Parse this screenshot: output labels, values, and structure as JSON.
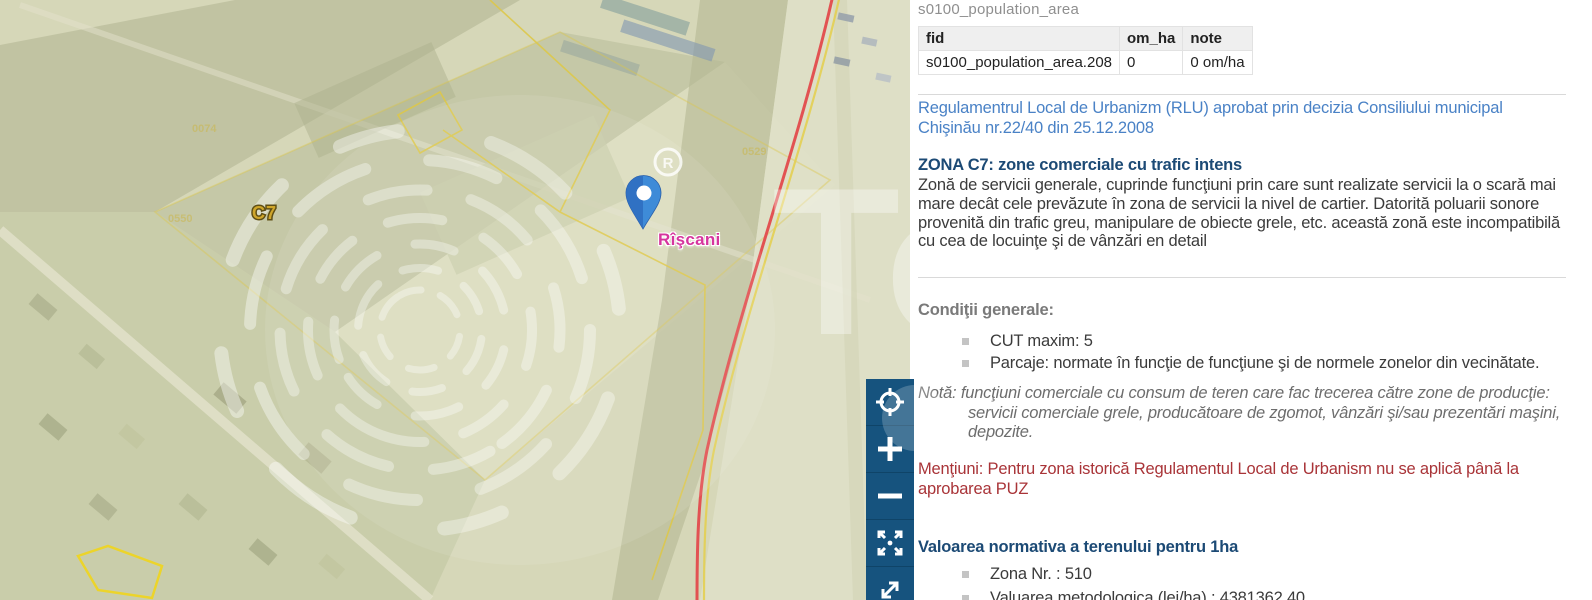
{
  "map": {
    "zone_label": "C7",
    "marker_label": "Rîşcani",
    "registered_mark": "R",
    "watermark_text": "To",
    "parcel_numbers": [
      "0074",
      "0550",
      "0529"
    ],
    "colors": {
      "base_khaki": "#d6d7b8",
      "zone_gold": "#c9a227",
      "marker_pink": "#d6359e",
      "marker_blue": "#3e8bd8",
      "route_red": "#e25252",
      "parcel_yellow": "#ddc84a"
    }
  },
  "toolbar": {
    "background": "#16537e",
    "buttons": [
      {
        "name": "locate",
        "icon": "target-icon"
      },
      {
        "name": "zoom-in",
        "icon": "plus-icon"
      },
      {
        "name": "zoom-out",
        "icon": "minus-icon"
      },
      {
        "name": "full-extent",
        "icon": "expand-arrows-icon"
      },
      {
        "name": "resize-diagonal",
        "icon": "diagonal-arrows-icon"
      }
    ]
  },
  "panel": {
    "table": {
      "title": "s0100_population_area",
      "columns": [
        "fid",
        "om_ha",
        "note"
      ],
      "rows": [
        [
          "s0100_population_area.208",
          "0",
          "0 om/ha"
        ]
      ]
    },
    "rlu_text": "Regulamentrul Local de Urbanizm (RLU) aprobat prin decizia Consiliului municipal Chişinău nr.22/40 din 25.12.2008",
    "zone_heading": "ZONA C7: zone comerciale cu trafic intens",
    "zone_description": "Zonă de servicii generale, cuprinde funcţiuni prin care sunt realizate servicii la o scară mai mare decât cele prevăzute în zona de servicii la nivel de cartier. Datorită poluarii sonore provenită din trafic greu, manipulare de obiecte grele, etc. această zonă este incompatibilă cu cea de locuinţe şi de vânzări en detail",
    "conditions": {
      "heading": "Condiţii generale:",
      "items": [
        "CUT maxim: 5",
        "Parcaje: normate în funcţie de funcţiune şi de normele zonelor din vecinătate."
      ]
    },
    "note": {
      "label": "Notă:",
      "text": "funcţiuni comerciale cu consum de teren care fac trecerea către zone de producţie: servicii comerciale grele, producătoare de zgomot, vânzări şi/sau prezentări maşini, depozite."
    },
    "mentions": {
      "label": "Menţiuni:",
      "text": "Pentru zona istorică Regulamentul Local de Urbanism nu se aplică până la aprobarea PUZ"
    },
    "valuation": {
      "heading": "Valoarea normativa a terenului pentru 1ha",
      "items": [
        "Zona Nr. : 510",
        "Valuarea metodologica (lei/ha) : 4381362.40"
      ]
    },
    "colors": {
      "link_blue": "#4a82c6",
      "heading_navy": "#1c4a75",
      "mention_red": "#a93438",
      "muted_gray": "#7a7a7a"
    }
  }
}
